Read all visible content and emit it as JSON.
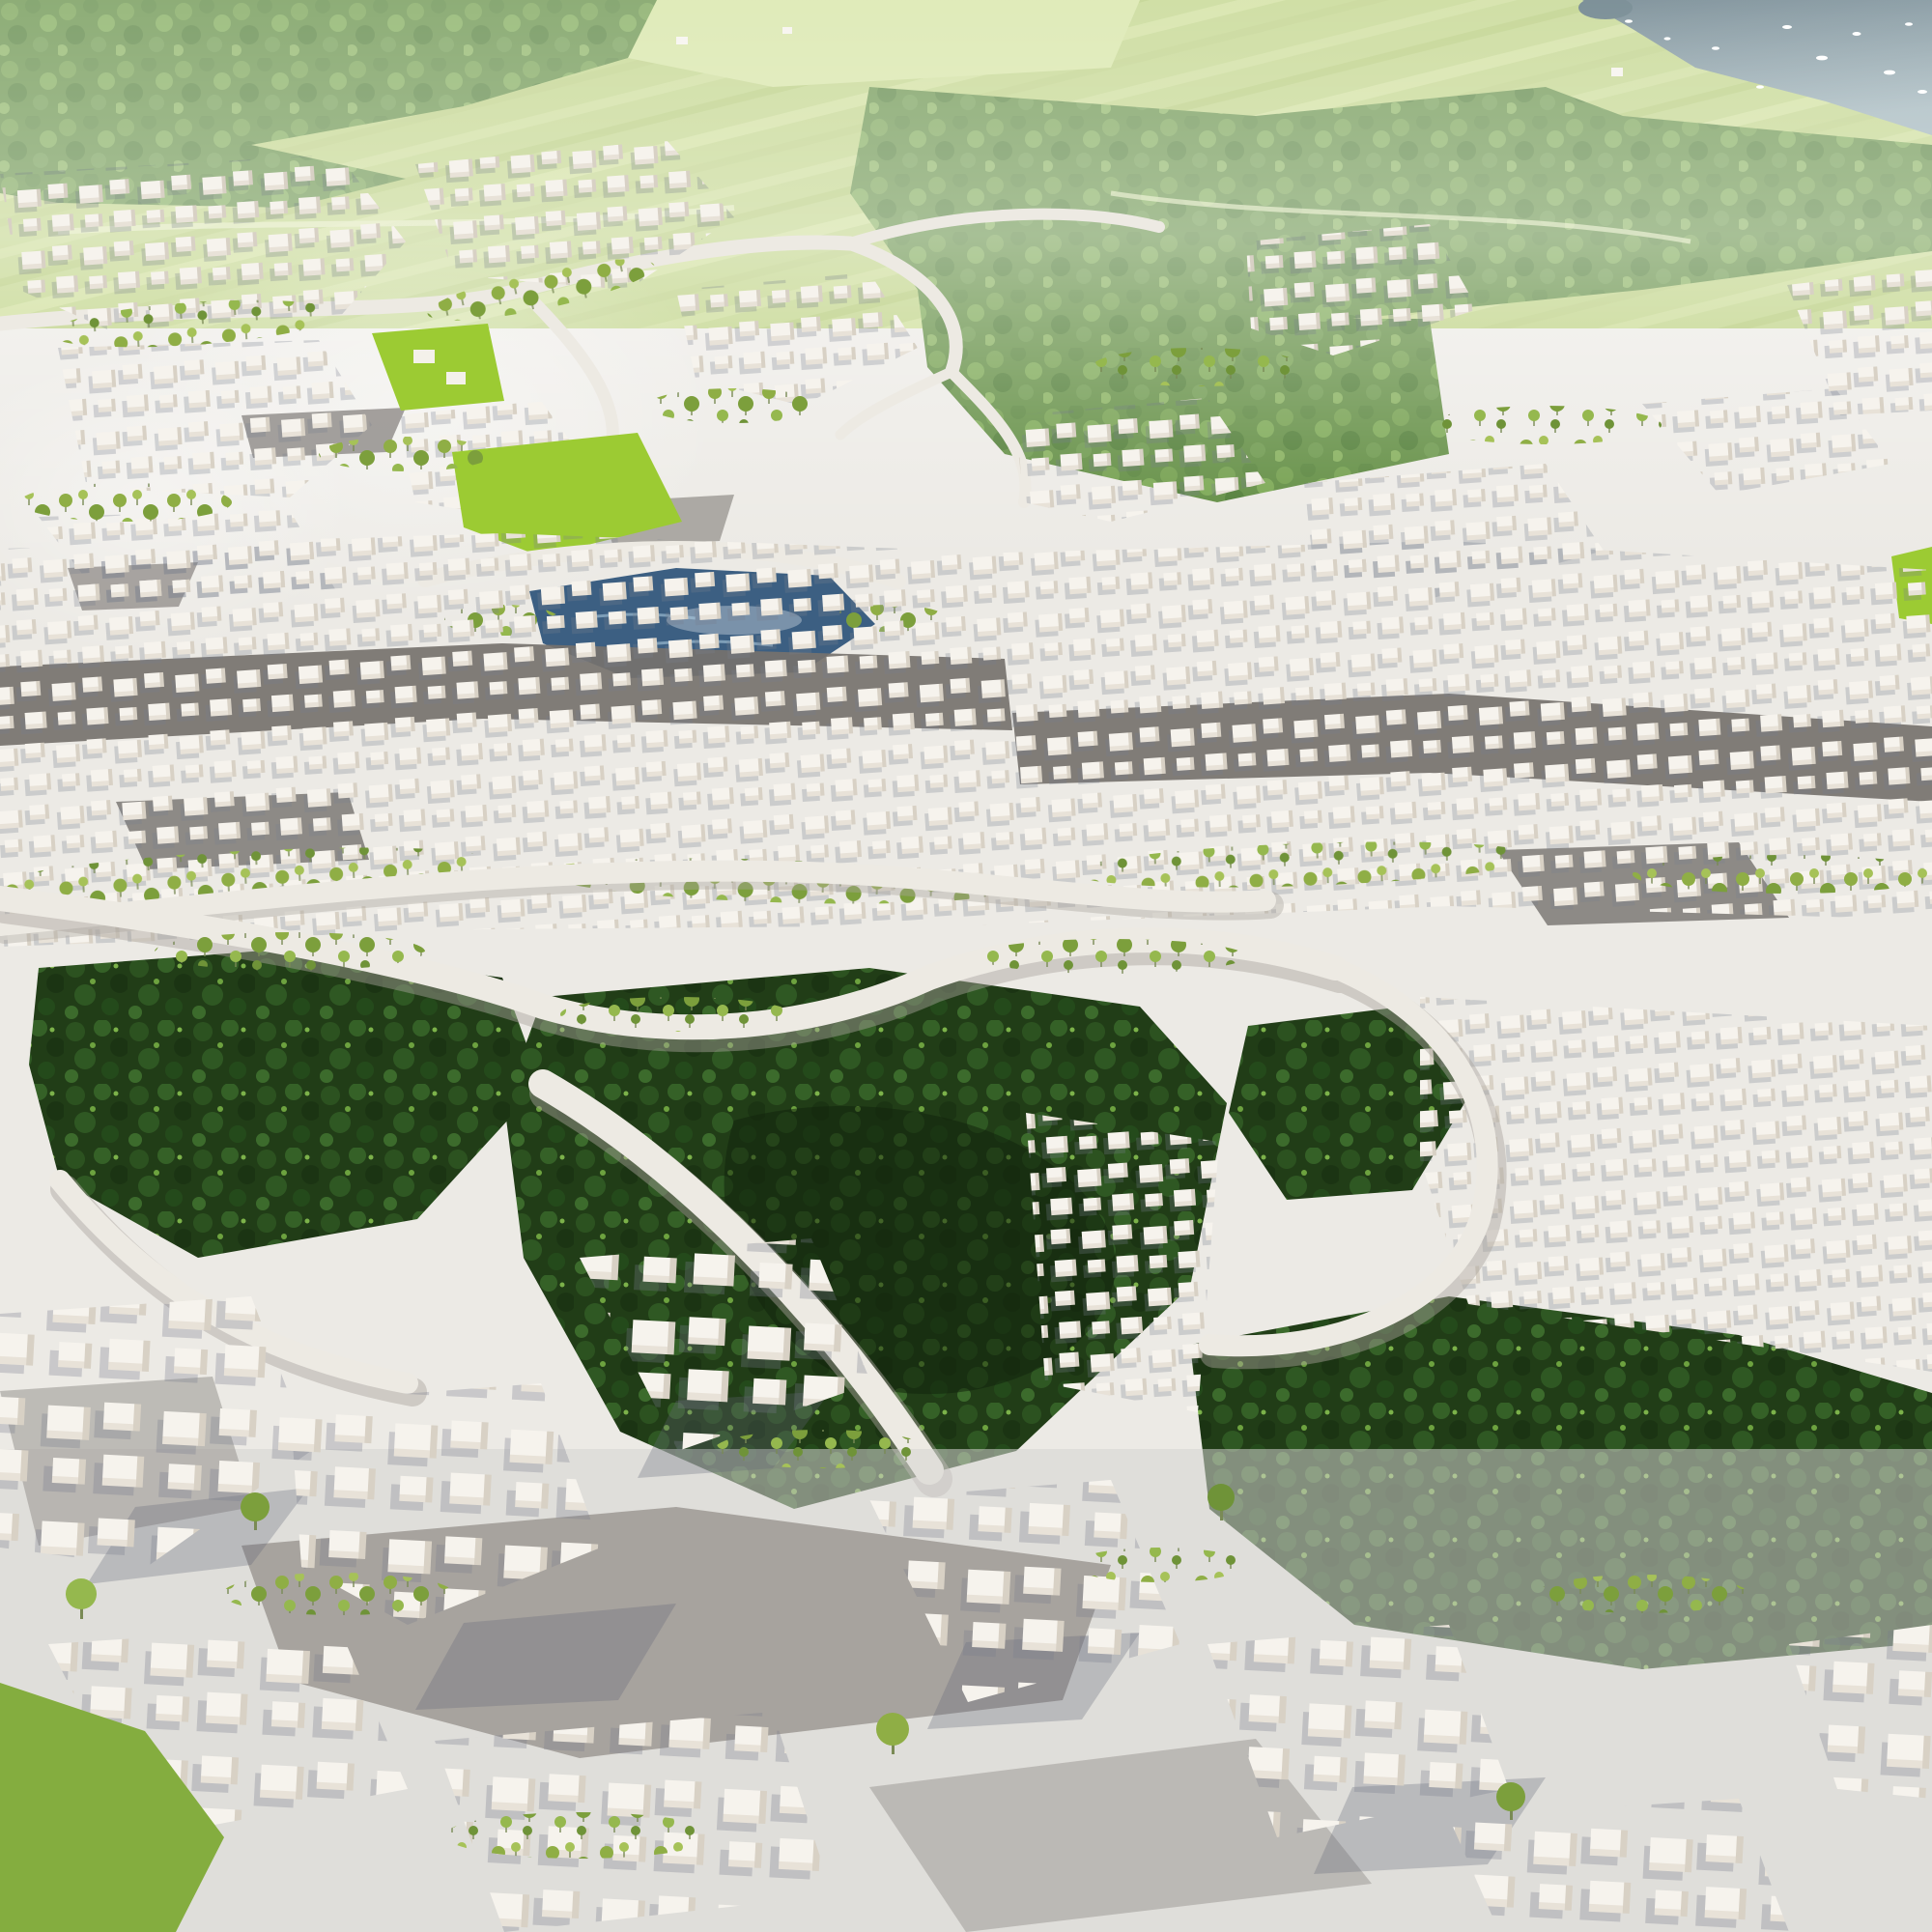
{
  "scene": {
    "description": "Aerial render of a car-free green city masterplan: white modular cube housing clusters among street trees, a central lake, bright lawns, deep sunken forest parks crossed by curved elevated paths, distant meadows and forested hills, and a bay with small boats at the top right.",
    "regions": [
      "bay-water",
      "boats",
      "shore-forest",
      "distant-meadows",
      "distant-forest",
      "upper-city-blocks",
      "bright-lawn",
      "central-lake",
      "mid-city-band",
      "dark-streets",
      "street-tree-rows",
      "sunken-forest-park",
      "elevated-path",
      "foreground-city-blocks",
      "foreground-lawn"
    ]
  },
  "palette": {
    "ground_light": "#eceae5",
    "ground_fore": "#d6d3d1",
    "cube_top": "#f6f3ed",
    "cube_side": "#d8d1c5",
    "cube_front": "#e8e2d8",
    "street_dark": "#76726e",
    "street_mid": "#98948f",
    "road_light": "#edeae3",
    "road_shadow": "#aaa59e",
    "field_base": "#bcd180",
    "field_light": "#d2e29c",
    "lawn": "#9ccb33",
    "lawn_fore": "#84ad3f",
    "forest_mid_base": "#5d8a3d",
    "forest_dark_base": "#213d17",
    "water_top": "#4e6874",
    "water_haze": "#94abb2",
    "lake": "#3c5f82",
    "lake_glint": "#a9c8dc",
    "boat": "#ffffff",
    "shadow": "rgba(100,104,120,0.30)",
    "house": "#f4f1ea"
  }
}
